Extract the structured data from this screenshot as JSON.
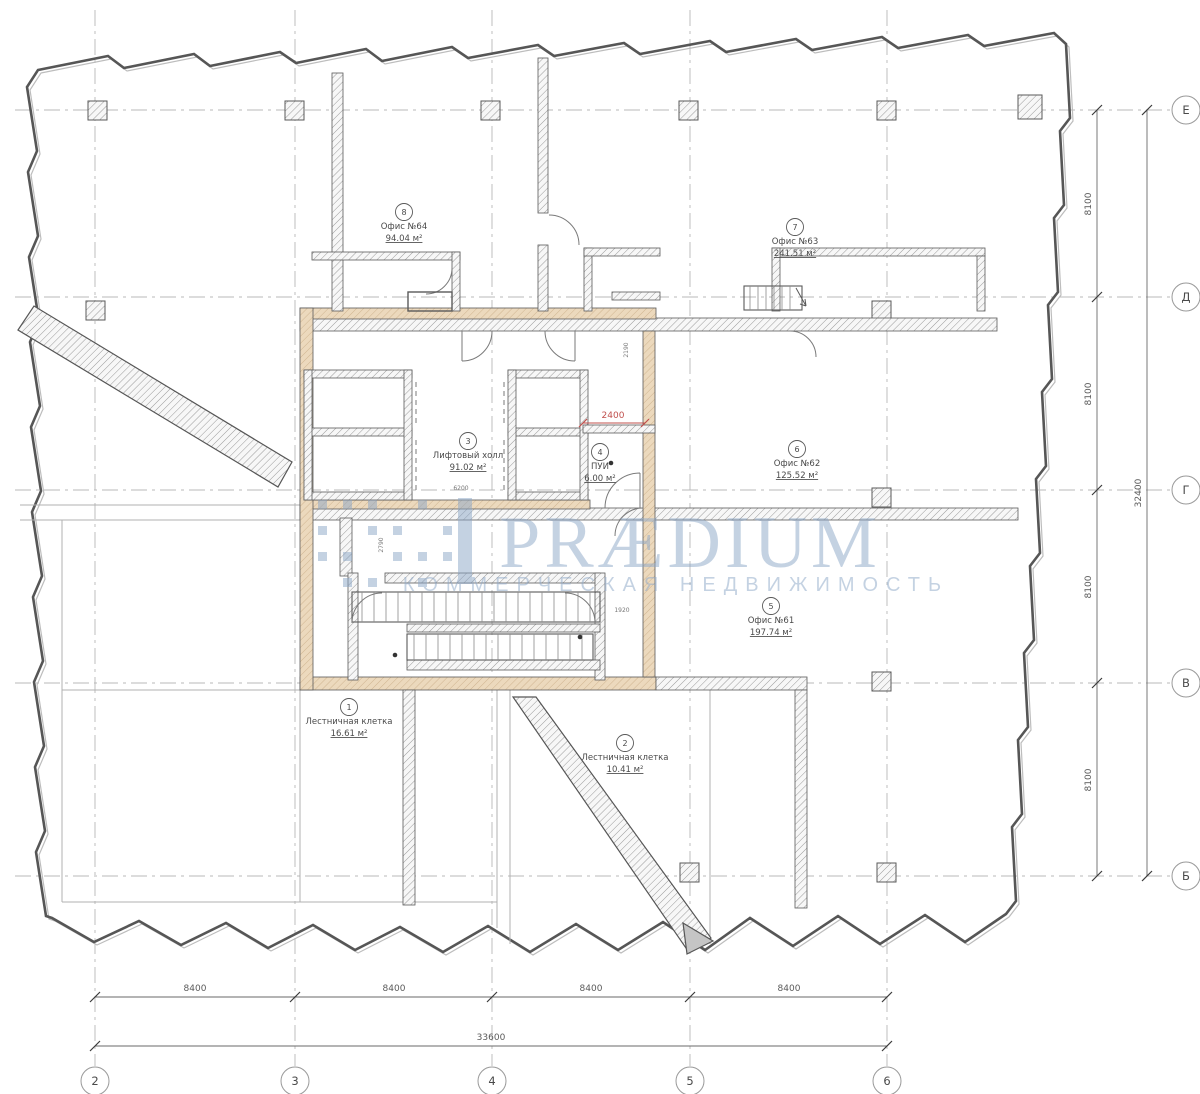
{
  "watermark": {
    "brand": "PRÆDIUM",
    "tagline": "КОММЕРЧЕСКАЯ НЕДВИЖИМОСТЬ"
  },
  "grid": {
    "cols": [
      "2",
      "3",
      "4",
      "5",
      "6"
    ],
    "rows": [
      "Е",
      "Д",
      "Г",
      "В",
      "Б"
    ]
  },
  "dimensions": {
    "col_spans": [
      "8400",
      "8400",
      "8400",
      "8400"
    ],
    "col_total": "33600",
    "row_spans": [
      "8100",
      "8100",
      "8100",
      "8100"
    ],
    "row_total": "32400",
    "red_dim": "2400",
    "small_dims": [
      "6200",
      "2190",
      "1920",
      "2790"
    ]
  },
  "rooms": [
    {
      "num": "1",
      "name": "Лестничная клетка",
      "area": "16.61 м²"
    },
    {
      "num": "2",
      "name": "Лестничная клетка",
      "area": "10.41 м²"
    },
    {
      "num": "3",
      "name": "Лифтовый холл",
      "area": "91.02 м²"
    },
    {
      "num": "4",
      "name": "ПУИ",
      "area": "6.00 м²"
    },
    {
      "num": "5",
      "name": "Офис №61",
      "area": "197.74 м²"
    },
    {
      "num": "6",
      "name": "Офис №62",
      "area": "125.52 м²"
    },
    {
      "num": "7",
      "name": "Офис №63",
      "area": "241.51 м²"
    },
    {
      "num": "8",
      "name": "Офис №64",
      "area": "94.04 м²"
    }
  ],
  "colors": {
    "wall_tan": "#ecd9bd",
    "hatch_gray": "#8f8f8f",
    "watermark_blue": "#8ba6c7",
    "dim_red": "#c0504d",
    "line_dark": "#4a4a4a"
  }
}
